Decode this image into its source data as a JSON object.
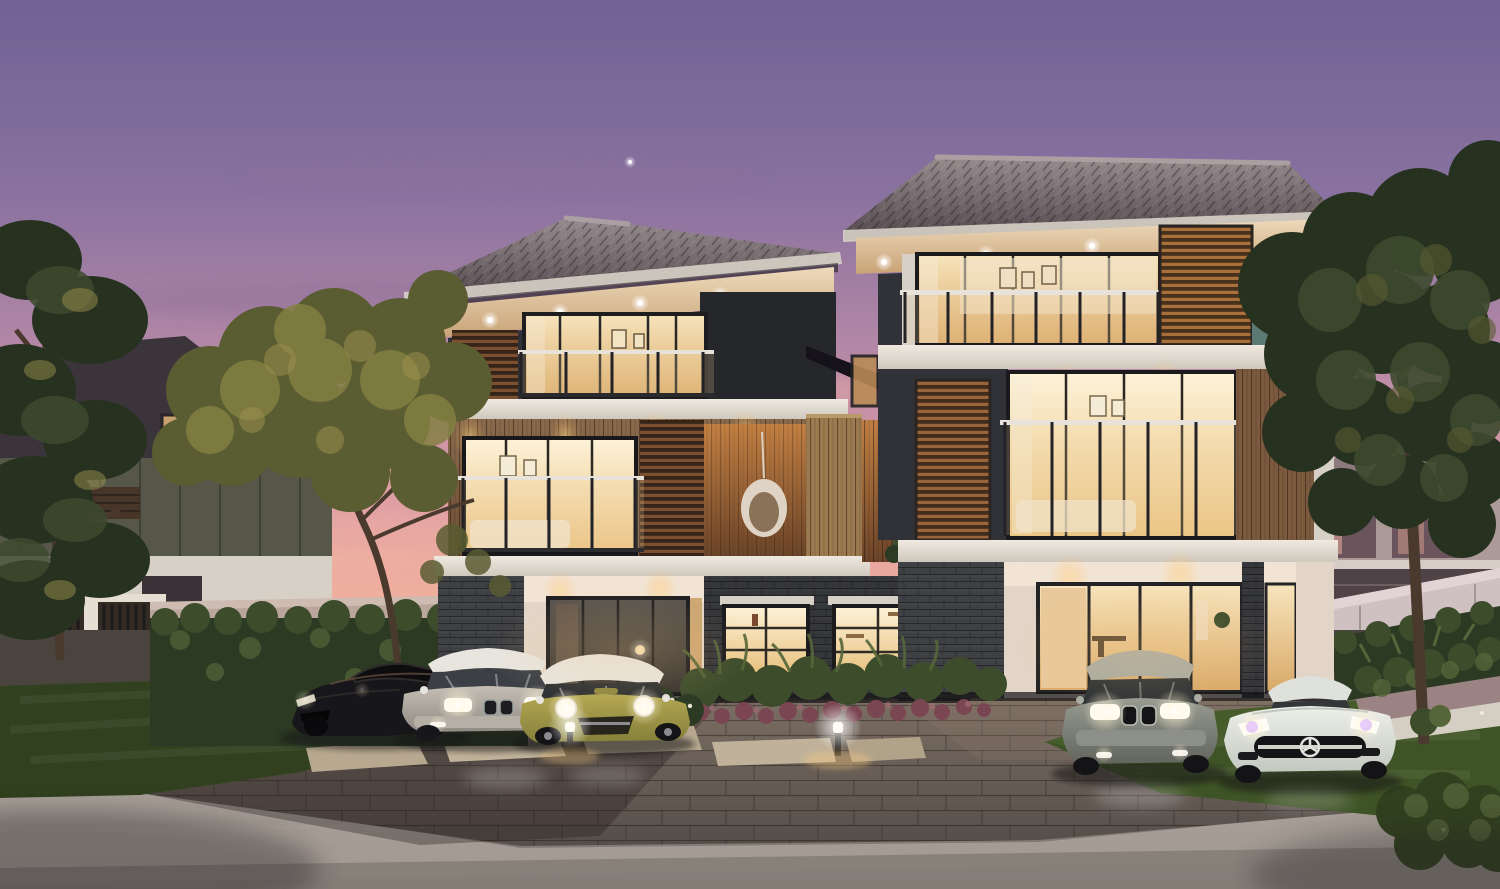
{
  "scene": {
    "type": "architectural exterior rendering",
    "time_of_day": "dusk",
    "description": "Twilight rendering of two modern three-storey townhouses with warm lit interiors, timber louver screens, glass balconies, five luxury cars parked on a paved driveway, landscaped hedges, flower beds, bollard path lights, flanking trees and a pink-purple sunset sky."
  },
  "buildings": {
    "left_house": {
      "storeys": 3,
      "features": [
        "hipped tile roof",
        "timber louver screens",
        "glass balcony railings",
        "hanging egg chair",
        "wood plank siding",
        "dark brick ground floor",
        "white entry porch",
        "recessed warm downlights"
      ]
    },
    "right_house": {
      "storeys": 3,
      "features": [
        "hipped tile roof",
        "dark louver tower",
        "teal accent wall",
        "glass balcony railings",
        "wood siding corner",
        "white stucco ground floor",
        "glass sliding doors",
        "recessed warm downlights"
      ]
    },
    "background_house_left": {
      "features": [
        "dark roof",
        "olive gable wall",
        "white lower wall",
        "small lit attic window"
      ]
    },
    "background_house_right": {
      "features": [
        "grey roof",
        "sunset-reflecting windows",
        "white trim"
      ]
    }
  },
  "vehicles": [
    {
      "name": "black-sports-car",
      "body_color": "#17161a",
      "position": "far left",
      "headlights": "dim"
    },
    {
      "name": "silver-sedan",
      "body_color": "#b9b3aa",
      "position": "left",
      "headlights": "on"
    },
    {
      "name": "olive-hatchback-white-roof",
      "body_color": "#a89c48",
      "roof_color": "#e8e5df",
      "position": "centre left",
      "headlights": "on"
    },
    {
      "name": "grey-sedan",
      "body_color": "#868a80",
      "position": "right",
      "headlights": "on"
    },
    {
      "name": "white-coupe-star-grille",
      "body_color": "#e9ebe6",
      "position": "far right",
      "headlights": "on"
    }
  ],
  "landscape": {
    "elements": [
      "black metal fence with white posts",
      "boundary wall",
      "clipped hedges",
      "lawn",
      "white flower shrubs",
      "fern bed with purple flowers",
      "stepping stones",
      "stone planter with pebble border",
      "paved driveway",
      "front road"
    ],
    "trees": [
      "dark pine left",
      "golden-olive tree centre-left",
      "large olive tree right"
    ],
    "bollard_lights": 2
  },
  "lighting": {
    "interior": "warm",
    "soffit_downlights": "on",
    "sky": "sunset gradient",
    "star_visible": true
  },
  "colors": {
    "sky_top": "#6f6294",
    "sky_upper": "#8a72a0",
    "sky_mid": "#b488a6",
    "sky_pink": "#d99aa6",
    "sky_peach": "#eeab9d",
    "sky_horizon": "#f4bfa6",
    "cloud_mauve": "#8d6f96",
    "cloud_pink": "#e8a9a4",
    "cloud_peach": "#f2b6a2",
    "roof_light": "#968b8d",
    "roof_dark": "#51474b",
    "roof_ridge": "#ab9fa2",
    "fascia": "#d6d0c7",
    "soffit_warm": "#eddabb",
    "soffit_deep": "#c9a377",
    "wall_charcoal": "#313237",
    "wall_charcoal_deep": "#26272b",
    "wall_teal": "#5b7a73",
    "louver_warm": "#7a5030",
    "louver_dark": "#3a2e23",
    "wood_siding_light": "#8a6a4c",
    "wood_siding": "#6e4e36",
    "wood_partition": "#9c7a50",
    "wood_gap_light": "#c27f42",
    "wood_gap": "#6b4428",
    "wood_right": "#7c5a3e",
    "slab_light": "#efe9e0",
    "slab_shade": "#cfc8bd",
    "brick_dark": "#3f4044",
    "brick_deep": "#35363a",
    "stucco": "#e2d5c8",
    "stucco_lit": "#f2e4d4",
    "glass_warm_top": "#f7e4bc",
    "glass_warm_bot": "#d9a968",
    "glass_bright_top": "#fdf2d8",
    "glass_bright_bot": "#e8c17e",
    "glass_cool_top": "#5a554f",
    "glass_cool_bot": "#39342f",
    "rail_white": "#e8e3da",
    "rail_dark": "#232226",
    "boundary_wall": "#bba69e",
    "boundary_wall_right": "#cfc0c1",
    "fence_white": "#e6ded2",
    "fence_dark": "#1c1b1d",
    "hedge_dark": "#2c3a24",
    "hedge_mid": "#3d4d2c",
    "hedge_light": "#55663a",
    "grass_dark": "#31411f",
    "grass_mid": "#3f5426",
    "grass_light": "#4e6430",
    "tree_dark": "#26321f",
    "tree_mid": "#3d4a2e",
    "tree_olive": "#5a5c32",
    "tree_gold": "#838042",
    "tree_highlight": "#9a8f4e",
    "trunk": "#4a3a2e",
    "trunk_light": "#6e5844",
    "planter_stone": "#9b8384",
    "pebble": "#d5cec2",
    "paver_warm": "#7d6f64",
    "paver": "#6b625c",
    "paver_dark": "#554e49",
    "road": "#979088",
    "road_light": "#a8a098",
    "road_dark": "#7e7872",
    "flower_purple": "#7a4652",
    "flower_white": "#e8e6da",
    "car_black": "#17161a",
    "car_silver_light": "#c4beb5",
    "car_silver_dark": "#8f8a82",
    "car_mini_light": "#b3a752",
    "car_mini_dark": "#86803a",
    "car_roof_white": "#e8e5df",
    "car_grey_light": "#979b91",
    "car_grey_dark": "#61655c",
    "car_white_light": "#eef0ea",
    "car_white_dark": "#c3c8c0",
    "interior_white": "#f3e6cd",
    "downlight": "#ffe9b8",
    "shadow": "#141316"
  }
}
